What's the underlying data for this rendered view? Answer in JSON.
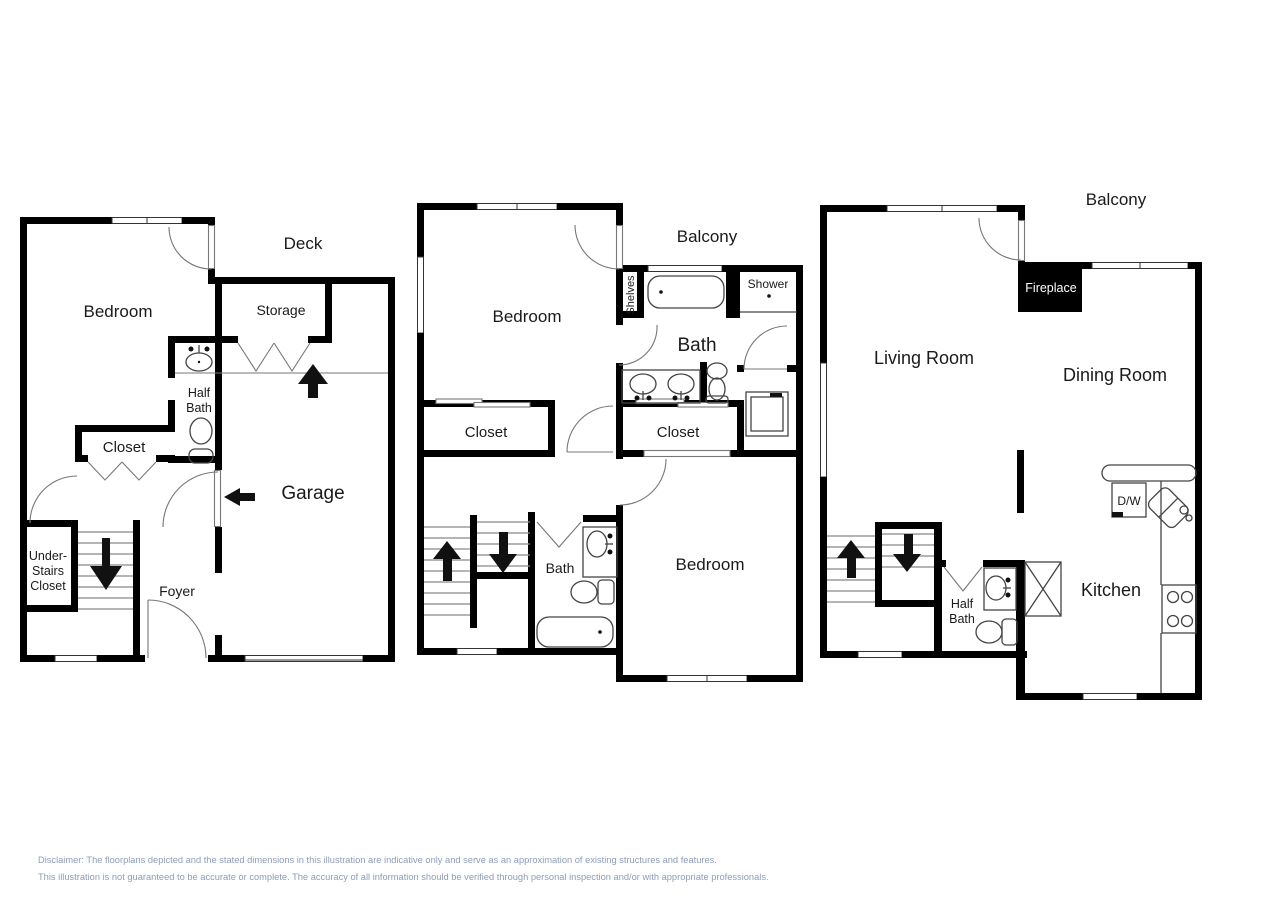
{
  "floors": {
    "floor1": {
      "rooms": {
        "bedroom": "Bedroom",
        "deck": "Deck",
        "storage": "Storage",
        "half_bath_line1": "Half",
        "half_bath_line2": "Bath",
        "closet": "Closet",
        "under_stairs_line1": "Under-",
        "under_stairs_line2": "Stairs",
        "under_stairs_line3": "Closet",
        "foyer": "Foyer",
        "garage": "Garage"
      }
    },
    "floor2": {
      "rooms": {
        "bedroom_upper": "Bedroom",
        "balcony": "Balcony",
        "shelves": "Shelves",
        "shower": "Shower",
        "bath_upper": "Bath",
        "closet_left": "Closet",
        "closet_right": "Closet",
        "bath_lower": "Bath",
        "bedroom_lower": "Bedroom"
      }
    },
    "floor3": {
      "rooms": {
        "balcony": "Balcony",
        "fireplace": "Fireplace",
        "living_room": "Living Room",
        "dining_room": "Dining Room",
        "dishwasher": "D/W",
        "half_bath_line1": "Half",
        "half_bath_line2": "Bath",
        "kitchen": "Kitchen"
      }
    }
  },
  "disclaimer": {
    "line1": "Disclaimer: The floorplans depicted and the stated dimensions in this illustration are indicative only and serve as an approximation of existing structures and features.",
    "line2": "This illustration is not guaranteed to be accurate or complete. The accuracy of all information should be verified through personal inspection and/or with appropriate professionals."
  },
  "colors": {
    "wall": "#000000",
    "fixture_line": "#444444",
    "door_line": "#777777",
    "label_text": "#1a1a1a",
    "fireplace_text": "#ffffff",
    "disclaimer_text": "#8d9cb6",
    "background": "#ffffff"
  }
}
